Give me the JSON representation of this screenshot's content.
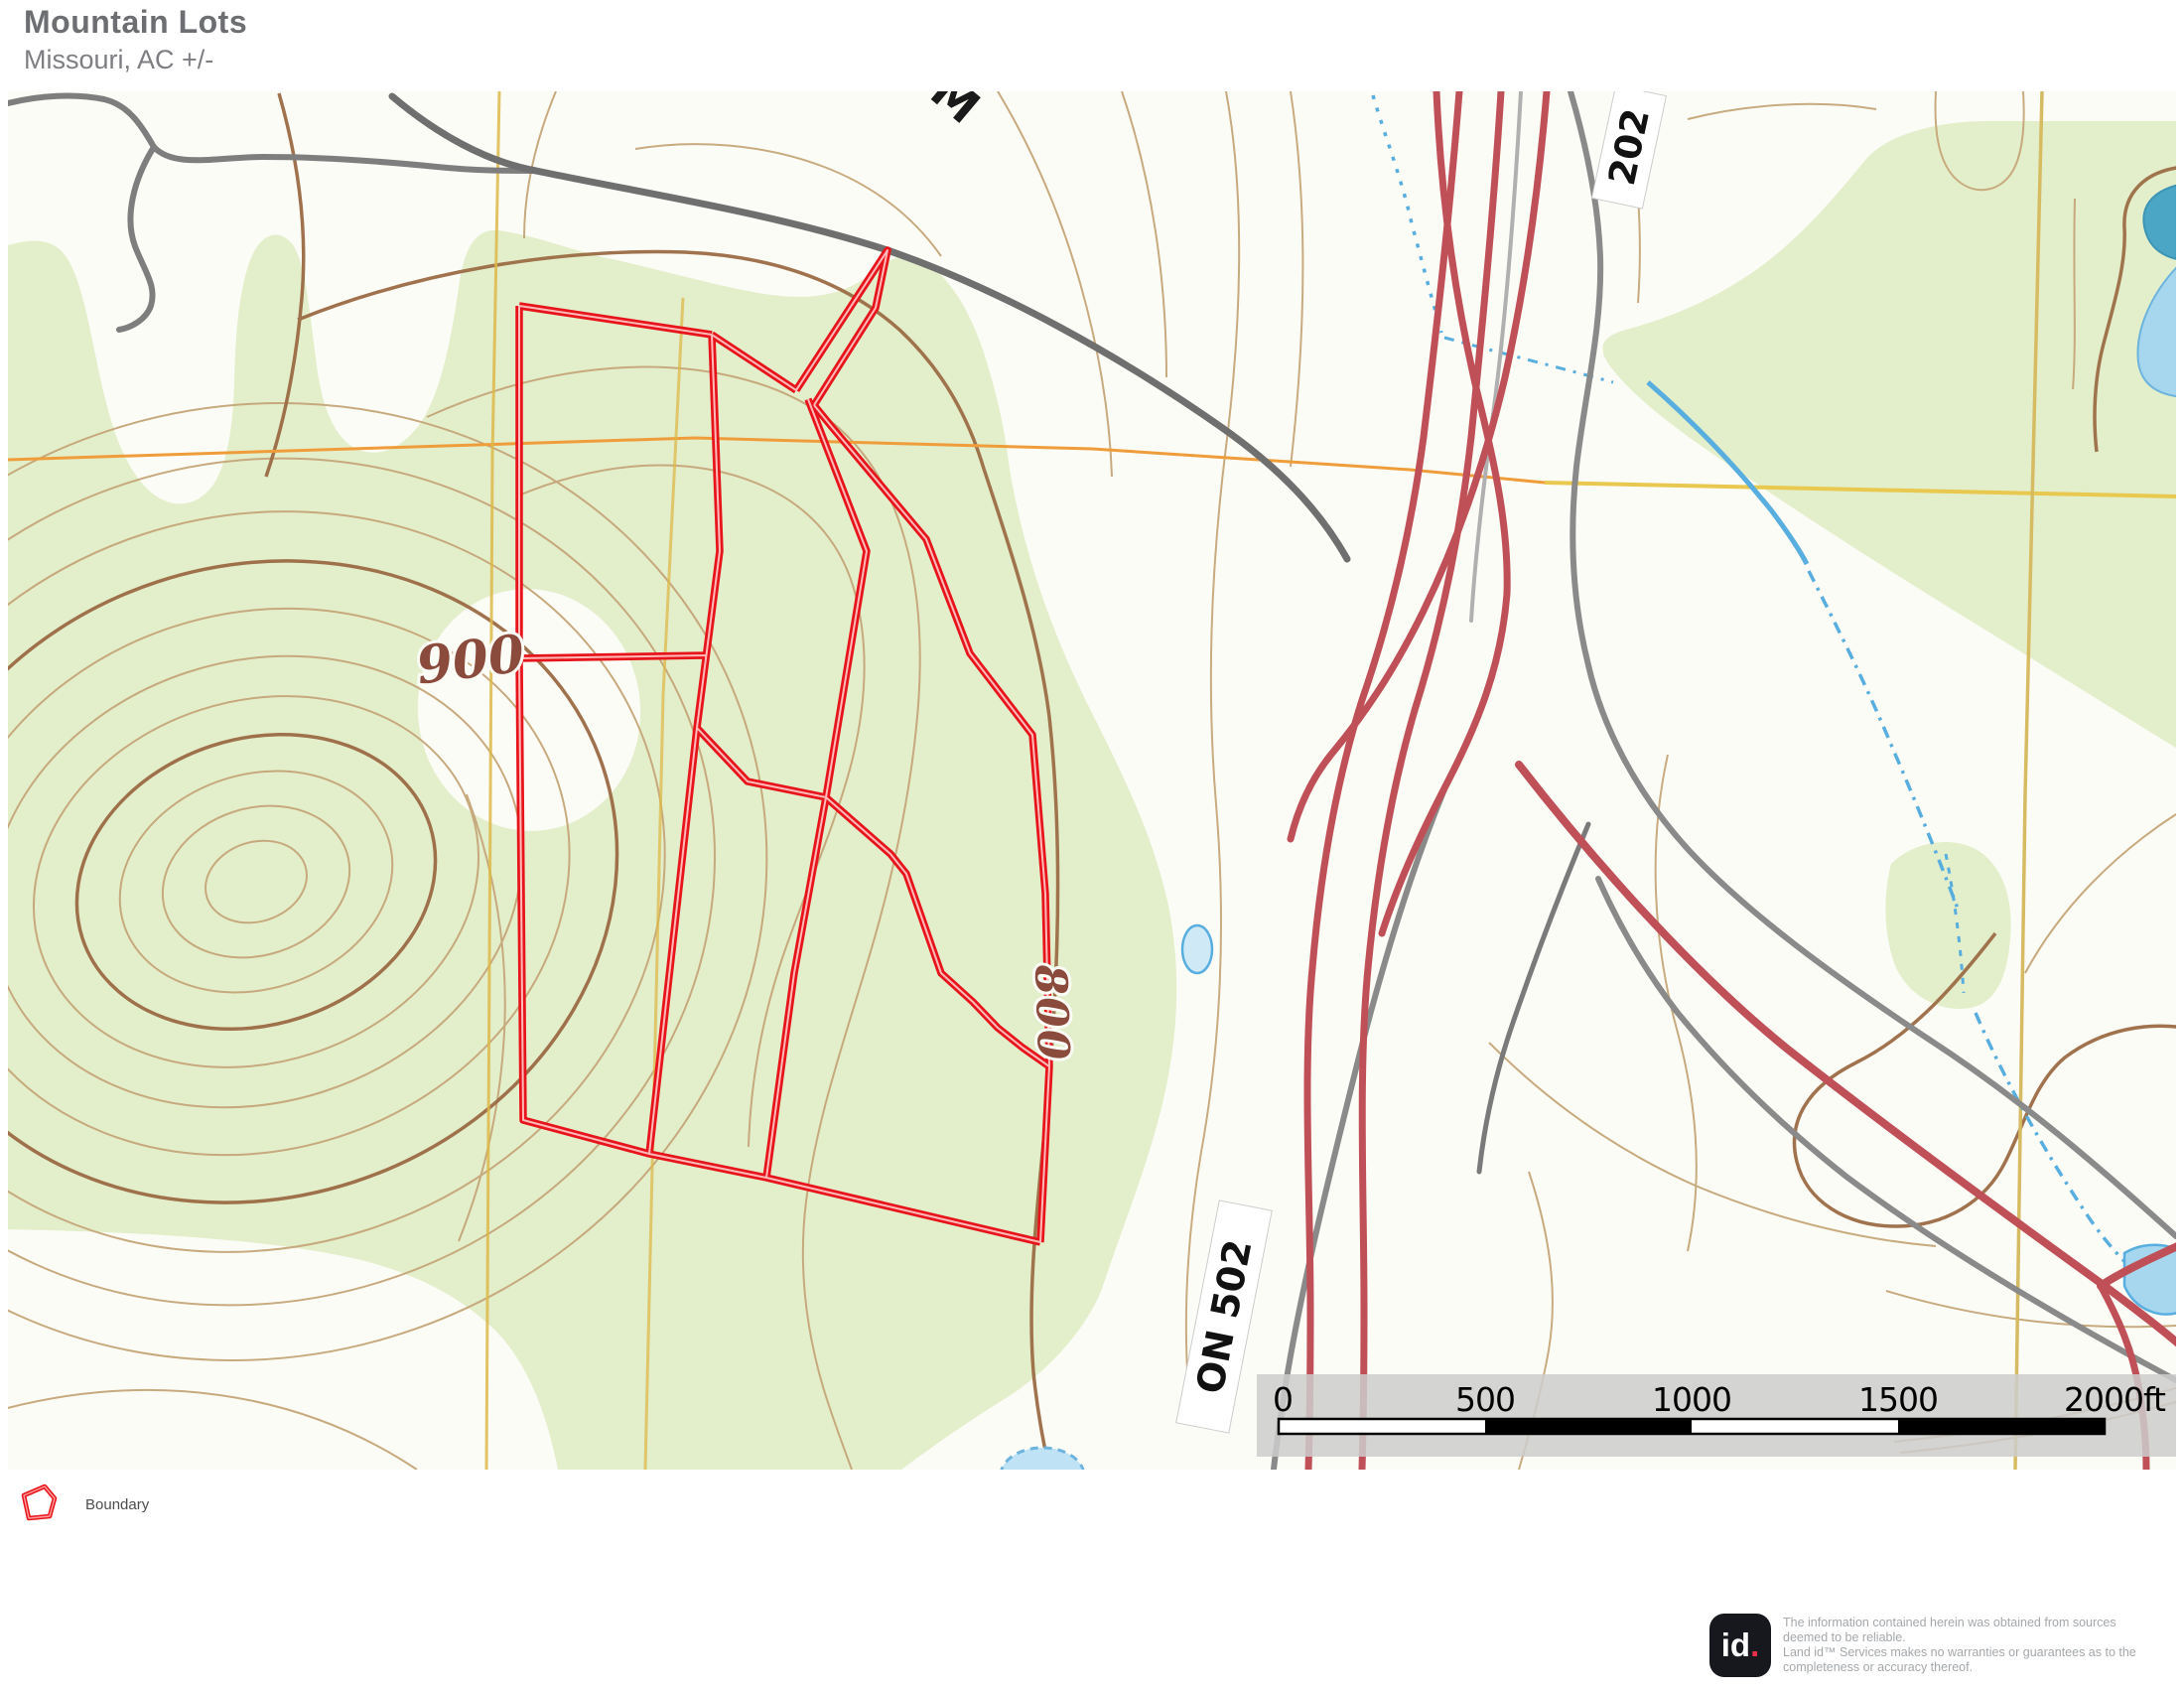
{
  "header": {
    "title": "Mountain Lots",
    "subtitle": "Missouri,  AC +/-"
  },
  "map": {
    "labels": {
      "contour_900": "900",
      "contour_800": "800",
      "highway_502": "ON 502",
      "highway_202": "202",
      "road_m": "M"
    },
    "colors": {
      "boundary_red": "#e8141b",
      "forest_green": "#e3eecb",
      "contour_brown": "#c5a678",
      "contour_index_brown": "#9b6b45",
      "highway_red": "#c05058",
      "road_gray": "#8f8f8f",
      "water_blue": "#58aede",
      "grid_yellow": "#ddb84a",
      "grid_orange": "#ef9d3a"
    }
  },
  "scalebar": {
    "labels": [
      "0",
      "500",
      "1000",
      "1500",
      "2000ft"
    ]
  },
  "legend": {
    "items": [
      {
        "label": "Boundary"
      }
    ]
  },
  "footer": {
    "logo_text": "id",
    "logo_dot": ".",
    "disclaimer_lines": [
      "The information contained herein was obtained from sources",
      "deemed to be reliable.",
      "  Land id™ Services makes no warranties or guarantees as to the",
      "completeness or accuracy thereof."
    ]
  }
}
